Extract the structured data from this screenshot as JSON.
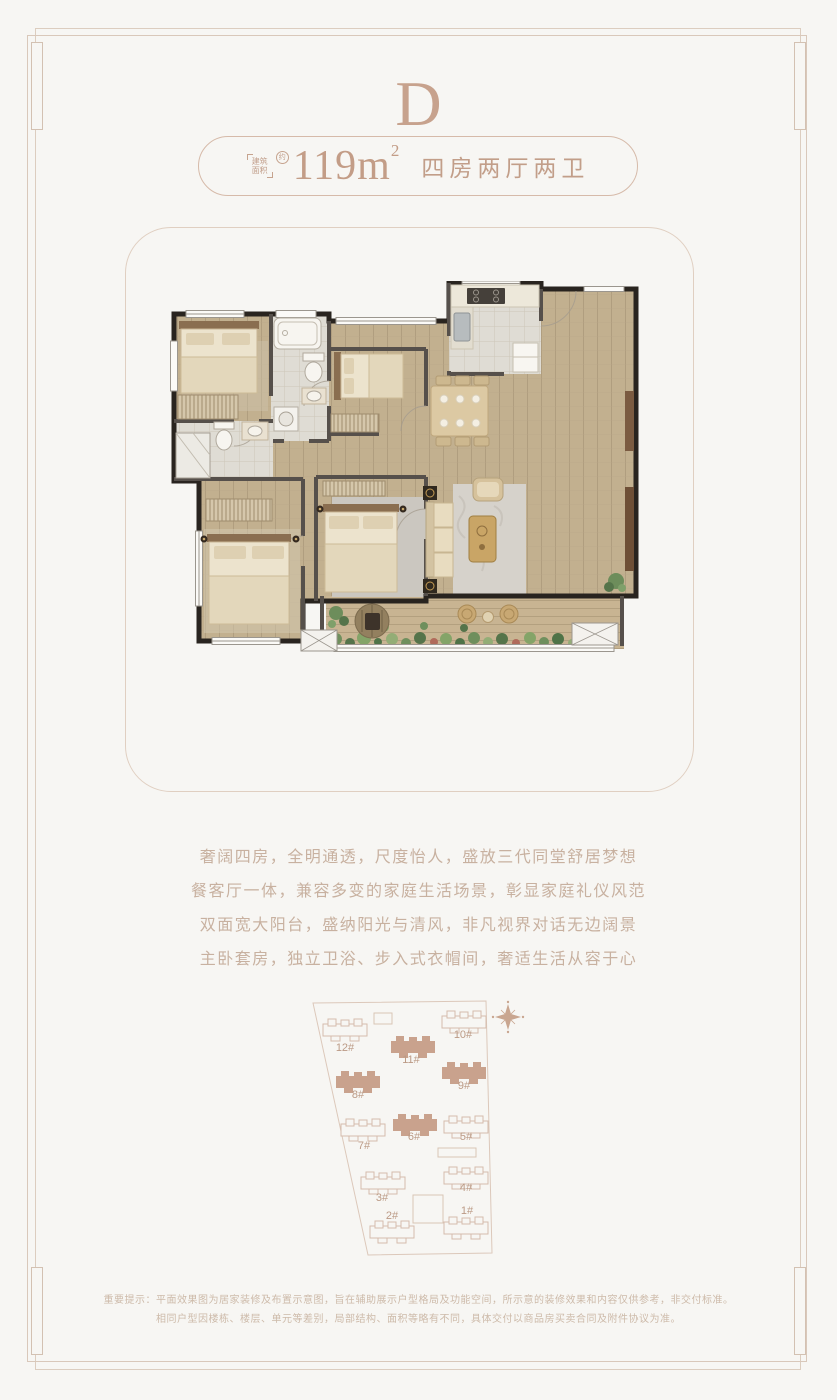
{
  "unit_letter": "D",
  "spec_pill": {
    "bracket_line1": "建筑",
    "bracket_line2": "面积",
    "approx": "约",
    "area_value": "119m",
    "area_sup": "2",
    "layout_text": "四房两厅两卫"
  },
  "description": {
    "lines": [
      "奢阔四房，全明通透，尺度怡人，盛放三代同堂舒居梦想",
      "餐客厅一体，兼容多变的家庭生活场景，彰显家庭礼仪风范",
      "双面宽大阳台，盛纳阳光与清风，非凡视界对话无边阔景",
      "主卧套房，独立卫浴、步入式衣帽间，奢适生活从容于心"
    ]
  },
  "site_plan": {
    "compass_icon": "compass-rose-icon",
    "buildings": [
      {
        "label": "12#",
        "x": 57,
        "y": 45,
        "lx": 57,
        "ly": 66,
        "filled": false
      },
      {
        "label": "11#",
        "x": 125,
        "y": 62,
        "lx": 123,
        "ly": 78,
        "filled": true
      },
      {
        "label": "10#",
        "x": 176,
        "y": 37,
        "lx": 175,
        "ly": 53,
        "filled": false
      },
      {
        "label": "8#",
        "x": 70,
        "y": 97,
        "lx": 70,
        "ly": 113,
        "filled": true
      },
      {
        "label": "9#",
        "x": 176,
        "y": 88,
        "lx": 176,
        "ly": 104,
        "filled": true
      },
      {
        "label": "7#",
        "x": 75,
        "y": 145,
        "lx": 76,
        "ly": 164,
        "filled": false
      },
      {
        "label": "6#",
        "x": 127,
        "y": 140,
        "lx": 126,
        "ly": 155,
        "filled": true
      },
      {
        "label": "5#",
        "x": 178,
        "y": 142,
        "lx": 178,
        "ly": 155,
        "filled": false
      },
      {
        "label": "3#",
        "x": 95,
        "y": 198,
        "lx": 94,
        "ly": 216,
        "filled": false
      },
      {
        "label": "4#",
        "x": 178,
        "y": 193,
        "lx": 178,
        "ly": 206,
        "filled": false
      },
      {
        "label": "2#",
        "x": 104,
        "y": 247,
        "lx": 104,
        "ly": 234,
        "filled": false
      },
      {
        "label": "1#",
        "x": 178,
        "y": 243,
        "lx": 179,
        "ly": 229,
        "filled": false
      }
    ]
  },
  "disclaimer": {
    "lines": [
      "重要提示：平面效果图为居家装修及布置示意图，旨在辅助展示户型格局及功能空间，所示意的装修效果和内容仅供参考，非交付标准。",
      "相同户型因楼栋、楼层、单元等差别，局部结构、面积等略有不同，具体交付以商品房买卖合同及附件协议为准。"
    ]
  },
  "colors": {
    "accent": "#c7a28d",
    "frame": "#d9c8ba",
    "building_fill": "#c9a28d",
    "building_outline": "#d5bcac",
    "wall_dark": "#29241f",
    "wood_floor": "#c2b08f"
  }
}
